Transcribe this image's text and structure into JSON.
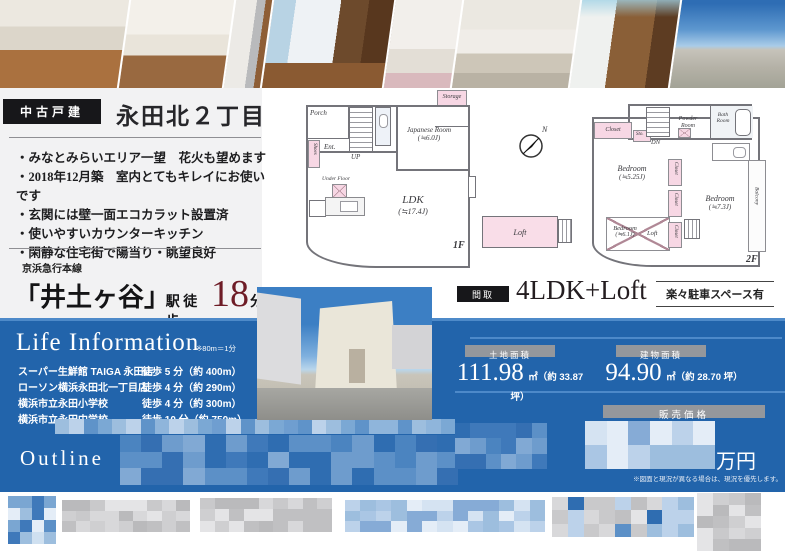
{
  "colors": {
    "panel_blue": "#2264ab",
    "panel_blue_light_line": "#4d89c9",
    "accent_red": "#6e1c26",
    "room_pink": "#f7d7e4",
    "label_black": "#17171a",
    "label_gray": "#94979c"
  },
  "property": {
    "type_label": "中古戸建",
    "title": "永田北２丁目",
    "features": [
      "・みなとみらいエリア一望　花火も望めます",
      "・2018年12月築　室内とてもキレイにお使いです",
      "・玄関には壁一面エコカラット設置済",
      "・使いやすいカウンターキッチン",
      "・閑静な住宅街で陽当り・眺望良好"
    ]
  },
  "station": {
    "line": "京浜急行本線",
    "name": "「井土ヶ谷」",
    "suffix": "駅 徒歩",
    "minutes": "18",
    "unit": "分"
  },
  "madori": {
    "label": "間取",
    "value": "4LDK+Loft",
    "parking": "楽々駐車スペース有"
  },
  "life": {
    "title": "Life Information",
    "note": "※80m＝1分",
    "items": [
      {
        "name": "スーパー生鮮館 TAIGA 永田店",
        "dist": "徒歩 5 分（約 400m）"
      },
      {
        "name": "ローソン横浜永田北一丁目店",
        "dist": "徒歩 4 分（約 290m）"
      },
      {
        "name": "横浜市立永田小学校",
        "dist": "徒歩 4 分（約 300m）"
      },
      {
        "name": "横浜市立永田中学校",
        "dist": "徒歩 10 分（約 750m）"
      }
    ]
  },
  "areas": {
    "land_label": "土地面積",
    "land_value": "111.98",
    "land_unit": "㎡（約 33.87 坪）",
    "bldg_label": "建物面積",
    "bldg_value": "94.90",
    "bldg_unit": "㎡（約 28.70 坪）"
  },
  "price": {
    "label": "販売価格",
    "unit": "万円",
    "note": "※図面と現況が異なる場合は、現況を優先します。"
  },
  "outline": {
    "title": "Outline"
  },
  "fp": {
    "f1": "1F",
    "f2": "2F",
    "porch": "Porch",
    "shoes": "Shoes",
    "ent": "Ent.",
    "up": "UP",
    "jroom": "Japanese Room",
    "jsize": "(≒6.0J)",
    "storage": "Storage",
    "underfloor": "Under Floor",
    "ldk": "LDK",
    "ldksize": "(≒17.4J)",
    "loft": "Loft",
    "closet": "Closet",
    "sto": "Sto.",
    "dn": "DN",
    "powder": "Powder Room",
    "bath": "Bath Room",
    "bed": "Bedroom",
    "b1size": "(≒5.25J)",
    "b2size": "(≒7.3J)",
    "b3size": "(≒6.1J)",
    "balcony": "Balcony",
    "compass_n": "N"
  },
  "photos": [
    "living-room",
    "kitchen",
    "kitchen-refrigerator",
    "bedroom",
    "laundry-room",
    "bathroom",
    "entrance-hall",
    "city-view",
    "house-exterior"
  ]
}
